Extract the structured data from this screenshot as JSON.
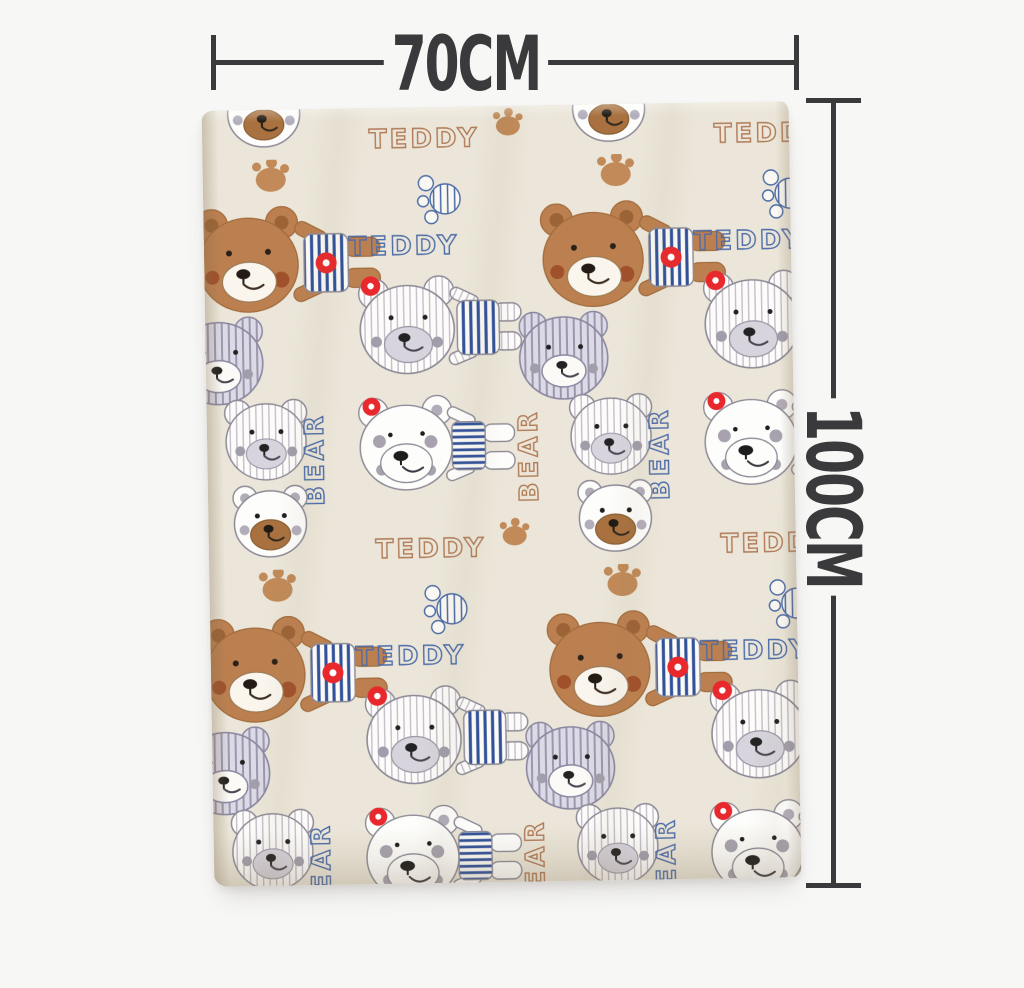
{
  "page": {
    "background_color": "#f7f7f6"
  },
  "dimension_annotations": {
    "line_color": "#3a3a3c",
    "width": {
      "label": "70CM"
    },
    "height": {
      "label": "100CM"
    }
  },
  "blanket": {
    "name": "teddy bear print baby blanket",
    "base_color": "#ebe6d9",
    "pattern": {
      "word_teddy": "TEDDY",
      "word_bear": "BEAR",
      "motifs": [
        "brown bear with navy striped top and red ring",
        "pinstripe bear with navy striped overalls and red ear ring",
        "white bear with red ear ring and striped sleeve",
        "lavender striped bear head",
        "small pinstripe bear head",
        "white bear head with brown muzzle",
        "tan paw print",
        "blue striped circle paw doodle"
      ],
      "colors": {
        "bear_brown": "#bc8050",
        "navy_stripe": "#31519a",
        "red_ring": "#e8282c",
        "lavender": "#dcdae6",
        "pinstripe_gray": "#bfbcc6",
        "paw_tan": "#c18a58",
        "word_navy": "#4c6ca8",
        "word_brown": "#b07a56",
        "outline_gray": "#8d8a96"
      }
    }
  }
}
